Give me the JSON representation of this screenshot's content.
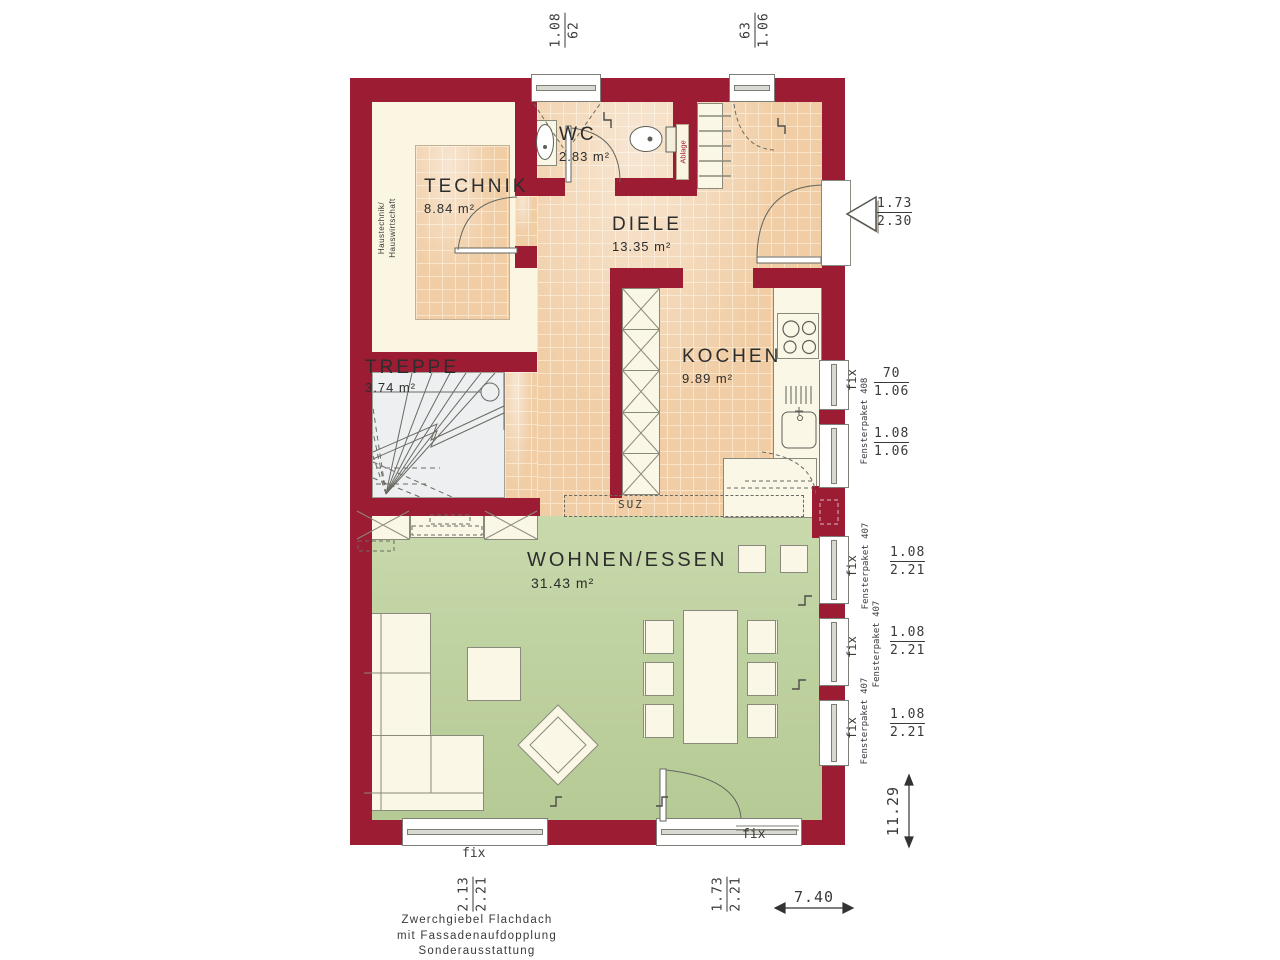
{
  "rooms": {
    "technik": {
      "name": "TECHNIK",
      "area": "8.84 m²"
    },
    "wc": {
      "name": "WC",
      "area": "2.83 m²"
    },
    "diele": {
      "name": "DIELE",
      "area": "13.35 m²"
    },
    "kochen": {
      "name": "KOCHEN",
      "area": "9.89 m²"
    },
    "treppe": {
      "name": "TREPPE",
      "area": "3.74 m²"
    },
    "wohnen": {
      "name": "WOHNEN/ESSEN",
      "area": "31.43 m²"
    }
  },
  "annotations": {
    "haustechnik_line1": "Haustechnik/",
    "haustechnik_line2": "Hauswirtschaft",
    "ablage": "Ablage",
    "suz": "SUZ"
  },
  "window_labels": {
    "fix": "fix",
    "fp407": "Fensterpaket 407",
    "fp408": "Fensterpaket 408"
  },
  "dimensions": {
    "top_window_1": {
      "num": "1.08",
      "den": "62"
    },
    "top_window_2": {
      "num": "63",
      "den": "1.06"
    },
    "entrance_door": {
      "num": "1.73",
      "den": "2.30"
    },
    "kitchen_window_1": {
      "num": "70",
      "den": "1.06"
    },
    "kitchen_window_2": {
      "num": "1.08",
      "den": "1.06"
    },
    "living_window_1": {
      "num": "1.08",
      "den": "2.21"
    },
    "living_window_2": {
      "num": "1.08",
      "den": "2.21"
    },
    "living_window_3": {
      "num": "1.08",
      "den": "2.21"
    },
    "bottom_window": {
      "num": "2.13",
      "den": "2.21"
    },
    "bottom_door": {
      "num": "1.73",
      "den": "2.21"
    },
    "total_depth": "11.29",
    "total_width": "7.40"
  },
  "footer": {
    "line1": "Zwerchgiebel Flachdach",
    "line2": "mit Fassadenaufdopplung",
    "line3": "Sonderausstattung"
  },
  "colors": {
    "wall": "#9c1c33",
    "tile_base": "#f0cda5",
    "tile_grid": "#f8e4c8",
    "cream": "#faf6e2",
    "green": "#c3d4a4",
    "stair": "#edeff1",
    "line": "#6a6a62",
    "text": "#3a3a3a",
    "red_text": "#9c1c33"
  }
}
